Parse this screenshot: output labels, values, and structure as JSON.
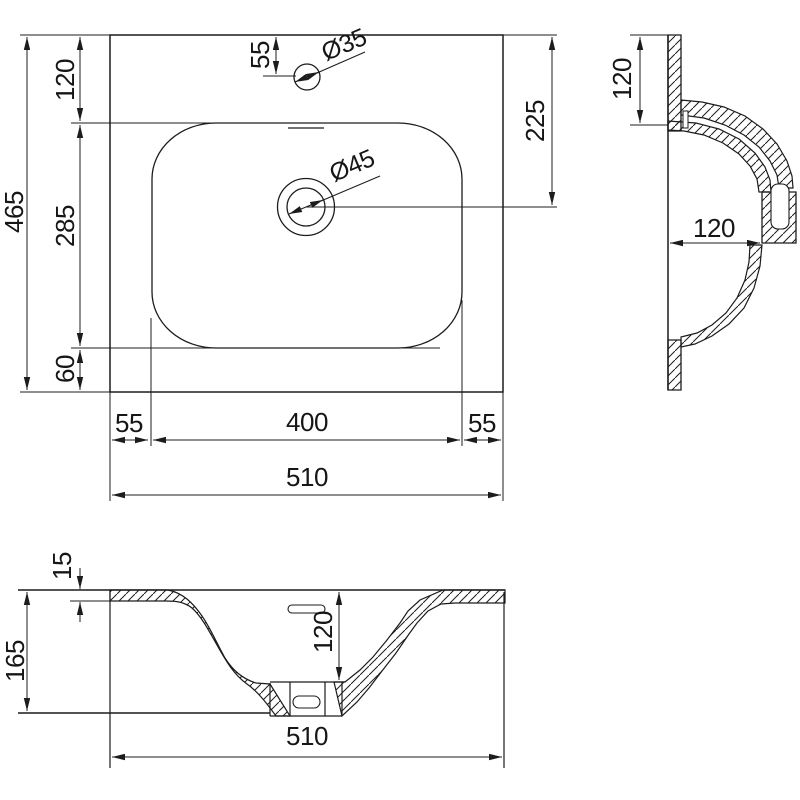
{
  "drawing": {
    "title": "washbasin-technical-drawing",
    "line_color": "#1c1c1c",
    "background": "#ffffff",
    "views": {
      "plan": {
        "name": "top-plan-view",
        "labels": {
          "total_height": "465",
          "seg_top": "120",
          "seg_mid": "285",
          "seg_bot": "60",
          "faucet_offset": "55",
          "faucet_dia": "Ø35",
          "drain_dia": "Ø45",
          "drain_offset": "225",
          "margin_left": "55",
          "basin_width": "400",
          "margin_right": "55",
          "total_width": "510"
        }
      },
      "side": {
        "name": "side-section-view",
        "labels": {
          "upper_height": "120",
          "inner_depth": "120"
        }
      },
      "front": {
        "name": "front-section-view",
        "labels": {
          "rim_thickness": "15",
          "total_height": "165",
          "bowl_depth": "120",
          "total_width": "510"
        }
      }
    }
  }
}
